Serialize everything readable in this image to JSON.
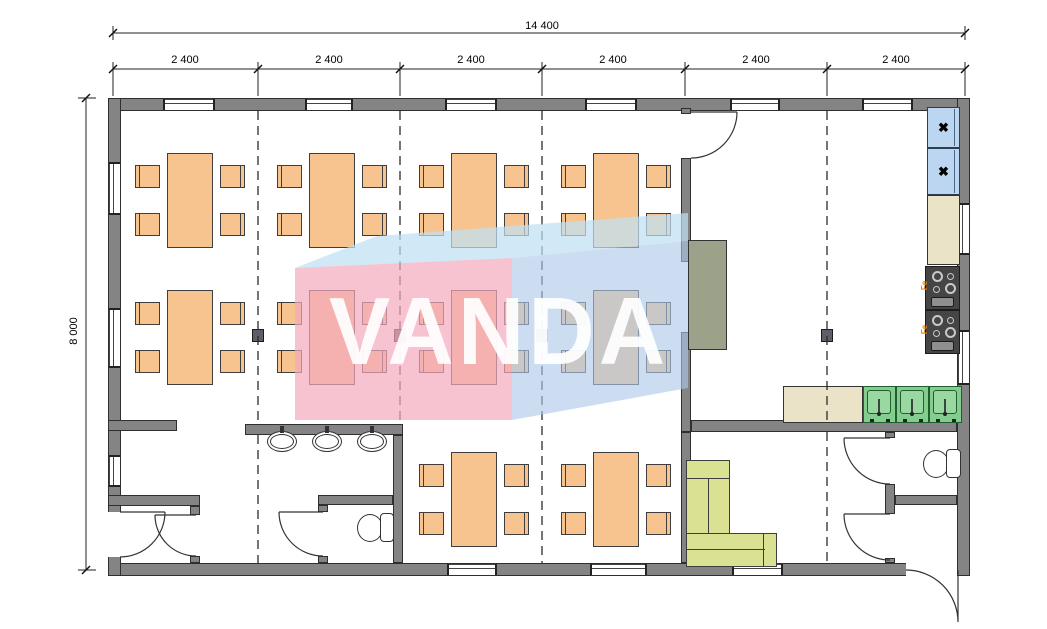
{
  "watermark": {
    "text": "VANDA"
  },
  "dimensions": {
    "total_width_mm": "14 400",
    "total_height_mm": "8 000",
    "bay_widths_mm": [
      "2 400",
      "2 400",
      "2 400",
      "2 400",
      "2 400",
      "2 400"
    ]
  },
  "stoves": [
    {
      "label": "Fe"
    },
    {
      "label": "Fe"
    }
  ],
  "icons": {
    "fridge_icon": "✖",
    "door-swing-icon": "quarter-arc",
    "module-axis-icon": "dashed-line"
  },
  "colors": {
    "wall": "#848484",
    "table": "#F7C490",
    "fridge": "#BCD6F2",
    "counter": "#EAE3C8",
    "stove": "#454545",
    "stove_label": "#E8861B",
    "sink": "#85CD8F",
    "sofa": "#DBE192",
    "serving_counter": "#9CA28A",
    "watermark_pink": "#F4A9BD",
    "watermark_blue": "#AFC8E8",
    "watermark_top": "#BFE0F2"
  },
  "inventory": {
    "dining_tables": 10,
    "chairs": 40,
    "wash_basins": 3,
    "kitchen_sinks": 3,
    "toilets": 2,
    "fridges": 2,
    "stoves": 2,
    "sofas": 1
  }
}
